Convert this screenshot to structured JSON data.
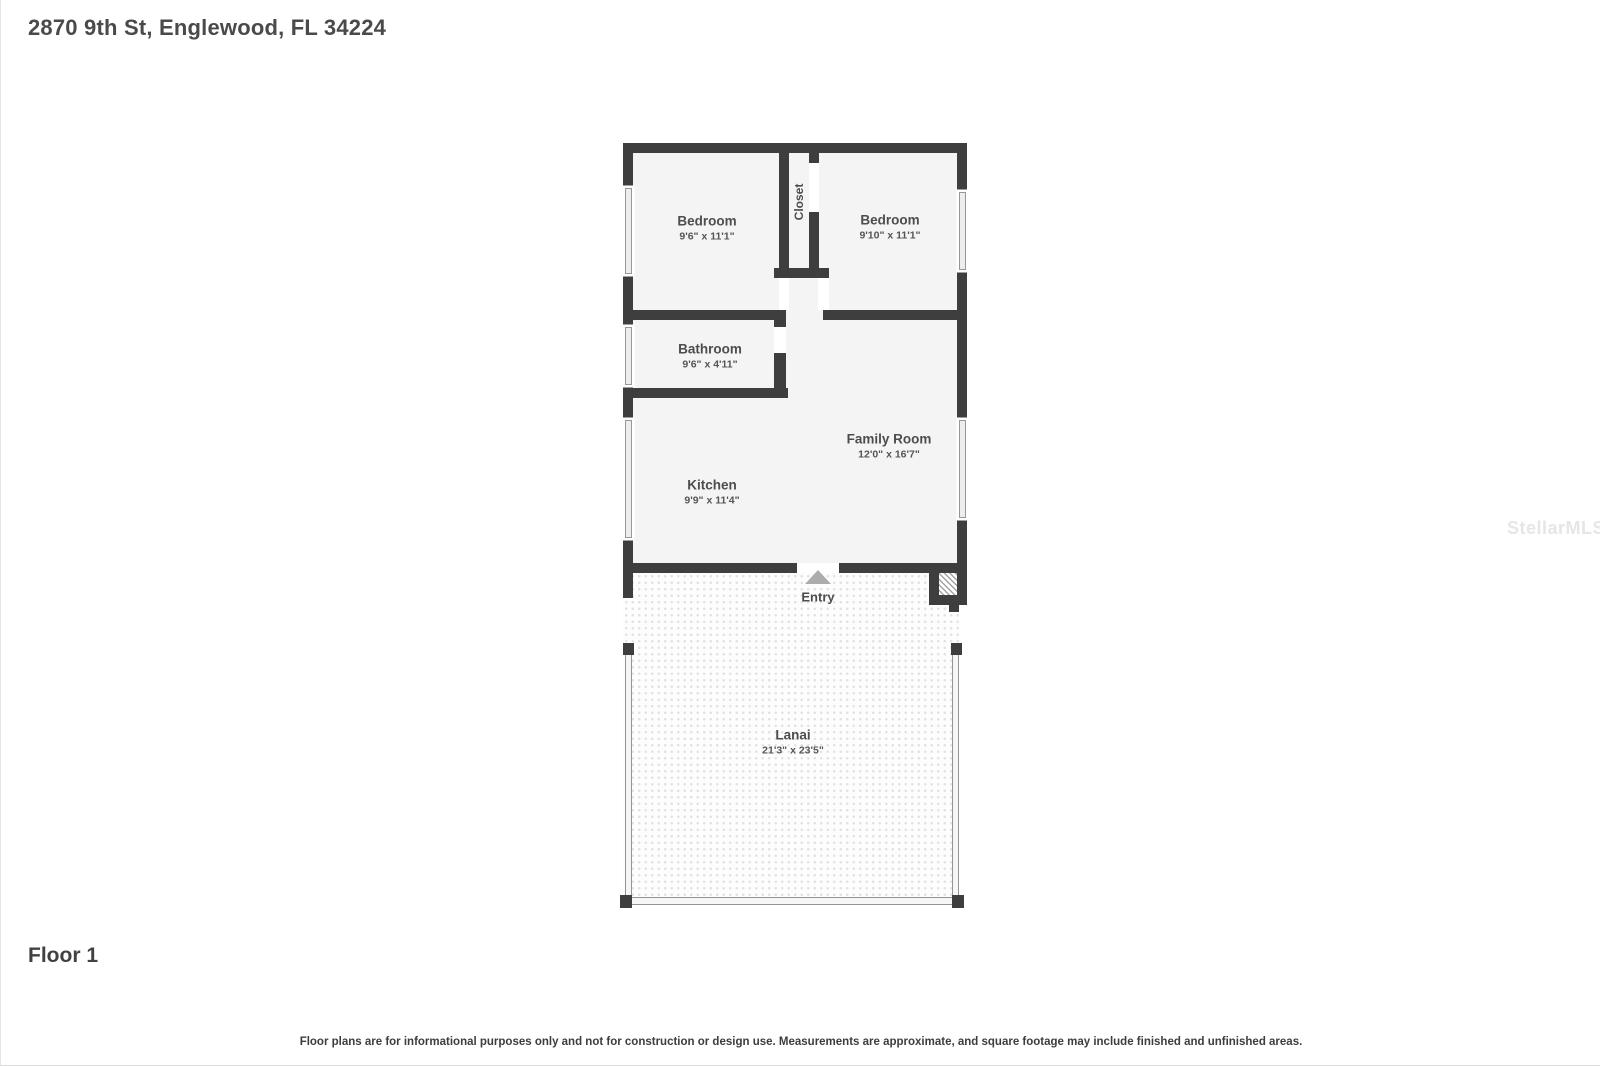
{
  "page": {
    "title": "2870 9th St, Englewood, FL 34224",
    "floor_label": "Floor 1",
    "disclaimer": "Floor plans are for informational purposes only and not for construction or design use. Measurements are approximate, and square footage may include finished and unfinished areas.",
    "watermark": "StellarMLS"
  },
  "plan": {
    "rooms": [
      {
        "name": "Bedroom",
        "dims": "9'6\" x 11'1\""
      },
      {
        "name": "Bedroom",
        "dims": "9'10\" x 11'1\""
      },
      {
        "name": "Bathroom",
        "dims": "9'6\" x 4'11\""
      },
      {
        "name": "Family Room",
        "dims": "12'0\" x 16'7\""
      },
      {
        "name": "Kitchen",
        "dims": "9'9\" x 11'4\""
      },
      {
        "name": "Lanai",
        "dims": "21'3\" x 23'5\""
      }
    ],
    "closet_label": "Closet",
    "entry_label": "Entry",
    "colors": {
      "wall": "#3e3e3e",
      "room_fill": "#f4f4f4",
      "label_text": "#4d4d4d",
      "entry_marker": "#acacac"
    }
  }
}
